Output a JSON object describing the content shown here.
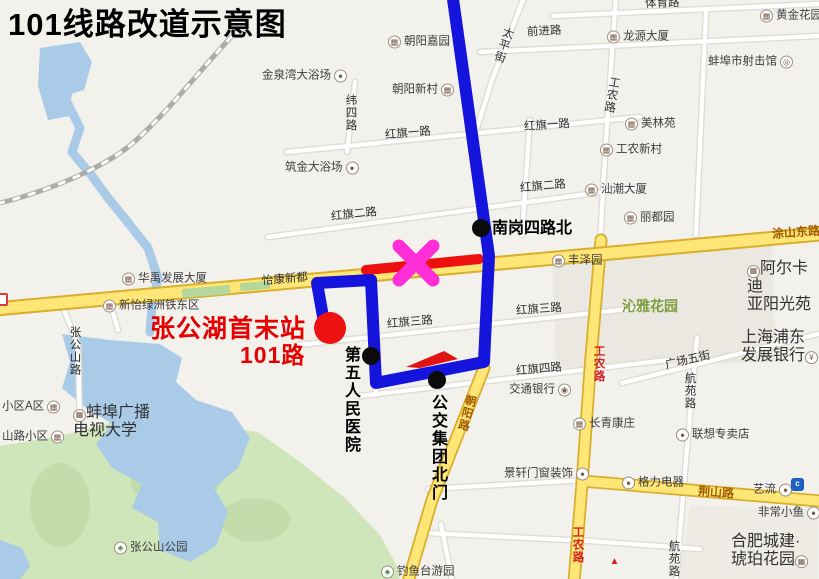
{
  "title": "101线路改道示意图",
  "route": {
    "line_color": "#1414dc",
    "closed_segment_color": "#ee0f0f",
    "closure_x_color": "#ff2ed8",
    "terminus_color": "#ee1111",
    "direction_arrow_color": "#e01212"
  },
  "stops": [
    {
      "name": "stop-nangang-silu-north",
      "label": "南岗四路北",
      "x": 481,
      "y": 228,
      "r": 9,
      "color": "#0c0c0c"
    },
    {
      "name": "stop-diwu-renmin-yiyuan",
      "label": "第五人民医院",
      "x": 371,
      "y": 356,
      "r": 9,
      "color": "#0c0c0c"
    },
    {
      "name": "stop-gongjiao-jituan-beimen",
      "label": "公交集团北门",
      "x": 437,
      "y": 380,
      "r": 9,
      "color": "#0c0c0c"
    },
    {
      "name": "terminus-zhanggonghu",
      "label": "张公湖首末站 101路",
      "x": 330,
      "y": 328,
      "r": 16,
      "color": "#ee1111"
    }
  ],
  "map": {
    "icon_glyphs": {
      "building": "▦",
      "dot": "●",
      "tree": "♣",
      "yuan": "¥",
      "bank": "◉",
      "target": "◎",
      "swirl": "c",
      "flame": "▲",
      "badge": ""
    },
    "standalone_icons": [
      {
        "type": "badge",
        "x": -3,
        "y": 302,
        "name": "road-number-badge-icon"
      },
      {
        "type": "swirl",
        "x": 791,
        "y": 482,
        "name": "bank-brand-icon"
      },
      {
        "type": "flame",
        "x": 608,
        "y": 560,
        "name": "brand-icon"
      }
    ],
    "labels": [
      {
        "t": "金泉湾大浴场",
        "x": 262,
        "y": 76,
        "c": "poi",
        "icon": "dot",
        "side": "right"
      },
      {
        "t": "朝阳嘉园",
        "x": 388,
        "y": 42,
        "c": "poi",
        "icon": "building",
        "side": "left"
      },
      {
        "t": "朝阳新村",
        "x": 392,
        "y": 90,
        "c": "poi",
        "icon": "building",
        "side": "right"
      },
      {
        "t": "前进路",
        "x": 527,
        "y": 32,
        "c": "road",
        "rot": -3
      },
      {
        "t": "太平街",
        "x": 503,
        "y": 26,
        "c": "roadv",
        "rot": 18
      },
      {
        "t": "体育路",
        "x": 645,
        "y": 4,
        "c": "road",
        "rot": -2
      },
      {
        "t": "龙源大厦",
        "x": 607,
        "y": 37,
        "c": "poi",
        "icon": "building",
        "side": "left"
      },
      {
        "t": "黄金花园",
        "x": 760,
        "y": 16,
        "c": "poi",
        "icon": "building",
        "side": "left"
      },
      {
        "t": "蚌埠市射击馆",
        "x": 708,
        "y": 62,
        "c": "poi",
        "icon": "target",
        "side": "right"
      },
      {
        "t": "工农路",
        "x": 611,
        "y": 76,
        "c": "roadv",
        "rot": 10
      },
      {
        "t": "美林苑",
        "x": 625,
        "y": 124,
        "c": "poi",
        "icon": "building",
        "side": "left"
      },
      {
        "t": "纬四路",
        "x": 350,
        "y": 94,
        "c": "roadv"
      },
      {
        "t": "红旗一路",
        "x": 385,
        "y": 134,
        "c": "road",
        "rot": -5
      },
      {
        "t": "红旗一路",
        "x": 524,
        "y": 126,
        "c": "road",
        "rot": -4
      },
      {
        "t": "工农新村",
        "x": 600,
        "y": 150,
        "c": "poi",
        "icon": "building",
        "side": "left"
      },
      {
        "t": "筑金大浴场",
        "x": 285,
        "y": 168,
        "c": "poi",
        "icon": "dot",
        "side": "right"
      },
      {
        "t": "红旗二路",
        "x": 331,
        "y": 215,
        "c": "road",
        "rot": -6
      },
      {
        "t": "红旗二路",
        "x": 520,
        "y": 187,
        "c": "road",
        "rot": -5
      },
      {
        "t": "汕潮大厦",
        "x": 585,
        "y": 190,
        "c": "poi",
        "icon": "building",
        "side": "left"
      },
      {
        "t": "丽都园",
        "x": 624,
        "y": 218,
        "c": "poi",
        "icon": "building",
        "side": "left"
      },
      {
        "t": "南岗四路北",
        "x": 492,
        "y": 229,
        "c": "callout",
        "n": "label-nangang-silu-north"
      },
      {
        "t": "涂山东路",
        "x": 772,
        "y": 233,
        "c": "yroad",
        "rot": -4
      },
      {
        "t": "丰泽园",
        "x": 552,
        "y": 261,
        "c": "poi",
        "icon": "building",
        "side": "left"
      },
      {
        "t": "怡康新都",
        "x": 262,
        "y": 280,
        "c": "road",
        "rot": -5
      },
      {
        "t": "华禹发展大厦",
        "x": 122,
        "y": 279,
        "c": "poi",
        "icon": "building",
        "side": "left"
      },
      {
        "t": "阿尔卡迪\n亚阳光苑",
        "x": 747,
        "y": 287,
        "c": "poi2",
        "icon": "building",
        "side": "left"
      },
      {
        "t": "新怡绿洲铁东区",
        "x": 103,
        "y": 306,
        "c": "poi",
        "icon": "building",
        "side": "left"
      },
      {
        "t": "沁雅花园",
        "x": 622,
        "y": 307,
        "c": "green"
      },
      {
        "t": "红旗三路",
        "x": 387,
        "y": 323,
        "c": "road",
        "rot": -5
      },
      {
        "t": "红旗三路",
        "x": 516,
        "y": 310,
        "c": "road",
        "rot": -4
      },
      {
        "t": "张公湖首末站",
        "x": 150,
        "y": 329,
        "c": "redbig",
        "fs": 25,
        "n": "label-terminus"
      },
      {
        "t": "101路",
        "x": 240,
        "y": 356,
        "c": "redbig",
        "fs": 23,
        "n": "label-terminus-route"
      },
      {
        "t": "张公山路",
        "x": 74,
        "y": 326,
        "c": "roadv"
      },
      {
        "t": "上海浦东\n发展银行",
        "x": 741,
        "y": 347,
        "c": "poi2",
        "icon": "yuan",
        "side": "right"
      },
      {
        "t": "广场五街",
        "x": 665,
        "y": 361,
        "c": "road",
        "rot": -13
      },
      {
        "t": "红旗四路",
        "x": 516,
        "y": 370,
        "c": "road",
        "rot": -5
      },
      {
        "t": "工农路",
        "x": 598,
        "y": 345,
        "c": "roadv redroadv"
      },
      {
        "t": "交通银行",
        "x": 509,
        "y": 390,
        "c": "poi",
        "icon": "bank",
        "side": "right"
      },
      {
        "t": "朝阳路",
        "x": 466,
        "y": 394,
        "c": "roadv yroadv",
        "rot": 15
      },
      {
        "t": "航苑路",
        "x": 689,
        "y": 372,
        "c": "roadv"
      },
      {
        "t": "长青康庄",
        "x": 573,
        "y": 424,
        "c": "poi",
        "icon": "building",
        "side": "left"
      },
      {
        "t": "第五人民医院",
        "x": 350,
        "y": 346,
        "c": "calloutv",
        "n": "label-diwu-renmin-yiyuan"
      },
      {
        "t": "公交集团北门",
        "x": 437,
        "y": 394,
        "c": "calloutv",
        "n": "label-gongjiao-jituan-beimen"
      },
      {
        "t": "小区A区",
        "x": 2,
        "y": 407,
        "c": "poi",
        "icon": "building",
        "side": "right"
      },
      {
        "t": "蚌埠广播\n电视大学",
        "x": 73,
        "y": 422,
        "c": "poi2",
        "icon": "building",
        "side": "left"
      },
      {
        "t": "山路小区",
        "x": 2,
        "y": 437,
        "c": "poi",
        "icon": "building",
        "side": "right"
      },
      {
        "t": "景轩门窗装饰",
        "x": 504,
        "y": 474,
        "c": "poi",
        "icon": "dot",
        "side": "right"
      },
      {
        "t": "联想专卖店",
        "x": 676,
        "y": 435,
        "c": "poi",
        "icon": "dot",
        "side": "left"
      },
      {
        "t": "格力电器",
        "x": 622,
        "y": 483,
        "c": "poi",
        "icon": "dot",
        "side": "left"
      },
      {
        "t": "荆山路",
        "x": 698,
        "y": 493,
        "c": "yroad",
        "rot": 4
      },
      {
        "t": "艺流",
        "x": 753,
        "y": 490,
        "c": "poi",
        "icon": "dot",
        "side": "right"
      },
      {
        "t": "非常小鱼",
        "x": 758,
        "y": 513,
        "c": "poi",
        "icon": "dot",
        "side": "right"
      },
      {
        "t": "合肥城建·\n琥珀花园",
        "x": 731,
        "y": 551,
        "c": "poi2",
        "icon": "building",
        "side": "right"
      },
      {
        "t": "张公山公园",
        "x": 114,
        "y": 548,
        "c": "poi",
        "icon": "tree",
        "side": "left"
      },
      {
        "t": "钓鱼台游园",
        "x": 381,
        "y": 572,
        "c": "poi",
        "icon": "tree",
        "side": "left"
      },
      {
        "t": "工农路",
        "x": 577,
        "y": 526,
        "c": "roadv redroadv"
      },
      {
        "t": "航苑路",
        "x": 673,
        "y": 540,
        "c": "roadv"
      }
    ]
  }
}
